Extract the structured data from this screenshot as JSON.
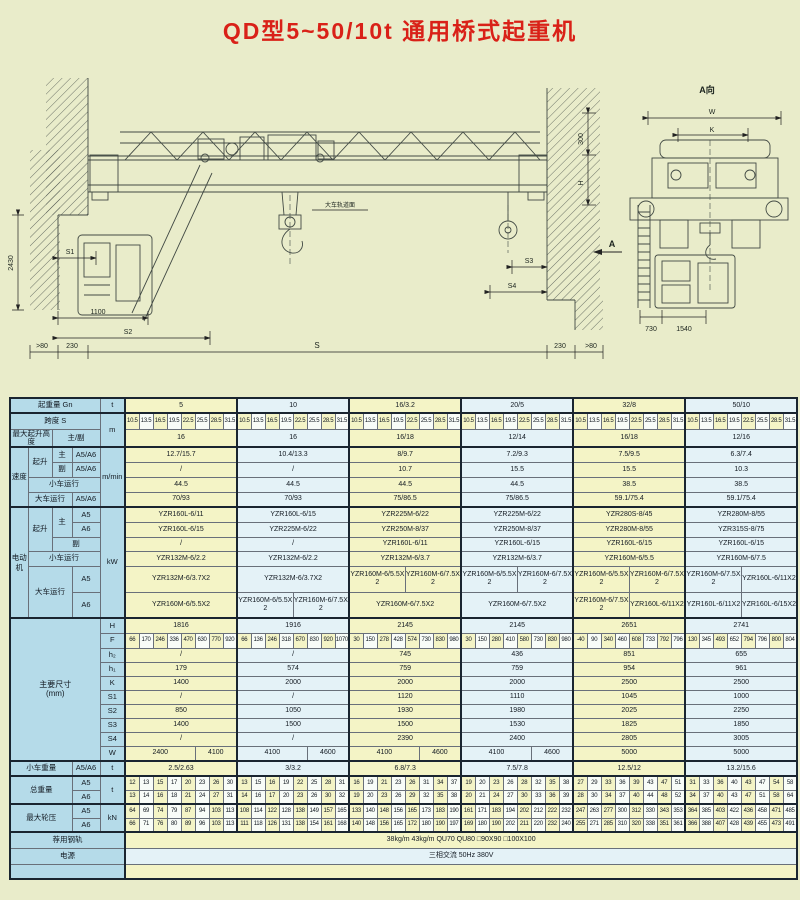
{
  "title": "QD型5~50/10t 通用桥式起重机",
  "drawing": {
    "view_label": "A向",
    "dim_W": "W",
    "dim_K": "K",
    "dim_S": "S",
    "dim_S1": "S1",
    "dim_S2": "S2",
    "dim_S3": "S3",
    "dim_S4": "S4",
    "dim_1100": "1100",
    "dim_2430": "2430",
    "dim_300": "300",
    "dim_H": "H",
    "dim_230_left": "230",
    "dim_230_right": "230",
    "gt80_left": ">80",
    "gt80_right": ">80",
    "rail_surface_note": "大车轨道面",
    "section_arrow": "A",
    "dim_730": "730",
    "dim_1540": "1540"
  },
  "table": {
    "labels": {
      "capacity": "起重量 Gn",
      "span": "跨度 S",
      "lift_height": "最大起升高度",
      "main_aux": "主/副",
      "speed": "速度",
      "hoist": "起升",
      "main": "主",
      "aux": "副",
      "trolley_travel": "小车运行",
      "crane_travel": "大车运行",
      "a5a6": "A5/A6",
      "a5": "A5",
      "a6": "A6",
      "motor": "电动机",
      "dims": "主要尺寸",
      "dims_unit": "(mm)",
      "trolley_weight": "小车重量",
      "total_weight": "总重量",
      "wheel_load": "最大轮压",
      "rail": "荐用钢轨",
      "power": "电源"
    },
    "units": {
      "capacity": "t",
      "span": "m",
      "speed": "m/min",
      "motor": "kW",
      "trolley_weight": "t",
      "total_weight": "t",
      "wheel_load": "kN"
    },
    "capacity_values": [
      "5",
      "10",
      "16/3.2",
      "20/5",
      "32/8",
      "50/10"
    ],
    "span_values": [
      [
        "10.5",
        "13.5",
        "16.5",
        "19.5",
        "22.5",
        "25.5",
        "28.5",
        "31.5"
      ],
      [
        "10.5",
        "13.5",
        "16.5",
        "19.5",
        "22.5",
        "25.5",
        "28.5",
        "31.5"
      ],
      [
        "10.5",
        "13.5",
        "16.5",
        "19.5",
        "22.5",
        "25.5",
        "28.5",
        "31.5"
      ],
      [
        "10.5",
        "13.5",
        "16.5",
        "19.5",
        "22.5",
        "25.5",
        "28.5",
        "31.5"
      ],
      [
        "10.5",
        "13.5",
        "16.5",
        "19.5",
        "22.5",
        "25.5",
        "28.5",
        "31.5"
      ],
      [
        "10.5",
        "13.5",
        "16.5",
        "19.5",
        "22.5",
        "25.5",
        "28.5",
        "31.5"
      ]
    ],
    "lift_height_values": [
      "16",
      "16",
      "16/18",
      "12/14",
      "16/18",
      "12/16"
    ],
    "speed": {
      "hoist_main": [
        "12.7/15.7",
        "10.4/13.3",
        "8/9.7",
        "7.2/9.3",
        "7.5/9.5",
        "6.3/7.4"
      ],
      "hoist_aux": [
        "/",
        "/",
        "10.7",
        "15.5",
        "15.5",
        "10.3"
      ],
      "trolley_travel": [
        "44.5",
        "44.5",
        "44.5",
        "44.5",
        "38.5",
        "38.5"
      ],
      "crane_travel": [
        "70/93",
        "70/93",
        "75/86.5",
        "75/86.5",
        "59.1/75.4",
        "59.1/75.4"
      ]
    },
    "motors": {
      "hoist_main_a5": [
        "YZR160L-6/11",
        "YZR160L-6/15",
        "YZR225M-6/22",
        "YZR225M-6/22",
        "YZR280S-8/45",
        "YZR280M-8/55"
      ],
      "hoist_main_a6": [
        "YZR160L-6/15",
        "YZR225M-6/22",
        "YZR250M-8/37",
        "YZR250M-8/37",
        "YZR280M-8/55",
        "YZR315S-8/75"
      ],
      "hoist_aux": [
        "/",
        "/",
        "YZR160L-6/11",
        "YZR160L-6/15",
        "YZR160L-6/15",
        "YZR160L-6/15"
      ],
      "trolley_travel": [
        "YZR132M-6/2.2",
        "YZR132M-6/2.2",
        "YZR132M-6/3.7",
        "YZR132M-6/3.7",
        "YZR160M-6/5.5",
        "YZR160M-6/7.5"
      ],
      "crane_travel_a5": [
        [
          "YZR132M-6/3.7X2"
        ],
        [
          "YZR132M-6/3.7X2"
        ],
        [
          "YZR160M-6/5.5X2",
          "YZR160M-6/7.5X2"
        ],
        [
          "YZR160M-6/5.5X2",
          "YZR160M-6/7.5X2"
        ],
        [
          "YZR160M-6/5.5X2",
          "YZR160M-6/7.5X2"
        ],
        [
          "YZR160M-6/7.5X2",
          "YZR160L-6/11X2"
        ]
      ],
      "crane_travel_a6": [
        [
          "YZR160M-6/5.5X2"
        ],
        [
          "YZR160M-6/5.5X2",
          "YZR160M-6/7.5X2"
        ],
        [
          "YZR160M-6/7.5X2"
        ],
        [
          "YZR160M-6/7.5X2"
        ],
        [
          "YZR160M-6/7.5X2",
          "YZR160L-6/11X2"
        ],
        [
          "YZR160L-6/11X2",
          "YZR160L-6/15X2"
        ]
      ]
    },
    "dim_names": [
      "H",
      "F",
      "h₂",
      "h₁",
      "K",
      "S1",
      "S2",
      "S3",
      "S4",
      "W"
    ],
    "dims": {
      "H": [
        "1816",
        "1916",
        "2145",
        "2145",
        "2651",
        "2741"
      ],
      "F": [
        [
          "66",
          "170",
          "246",
          "336",
          "470",
          "630",
          "770",
          "920"
        ],
        [
          "66",
          "136",
          "246",
          "318",
          "670",
          "830",
          "920",
          "1070"
        ],
        [
          "30",
          "150",
          "278",
          "428",
          "574",
          "730",
          "830",
          "980"
        ],
        [
          "30",
          "150",
          "280",
          "410",
          "580",
          "730",
          "830",
          "980"
        ],
        [
          "-40",
          "90",
          "340",
          "460",
          "608",
          "733",
          "792",
          "796"
        ],
        [
          "130",
          "345",
          "493",
          "652",
          "794",
          "796",
          "800",
          "804"
        ]
      ],
      "h2": [
        "/",
        "/",
        "745",
        "436",
        "851",
        "655"
      ],
      "h1": [
        "179",
        "574",
        "759",
        "759",
        "954",
        "961"
      ],
      "K": [
        "1400",
        "2000",
        "2000",
        "2000",
        "2500",
        "2500"
      ],
      "S1": [
        "/",
        "/",
        "1120",
        "1110",
        "1045",
        "1000"
      ],
      "S2": [
        "850",
        "1050",
        "1930",
        "1980",
        "2025",
        "2250"
      ],
      "S3": [
        "1400",
        "1500",
        "1500",
        "1530",
        "1825",
        "1850"
      ],
      "S4": [
        "/",
        "/",
        "2390",
        "2400",
        "2805",
        "3005"
      ],
      "W": [
        [
          "2400",
          "4100"
        ],
        [
          "4100",
          "4600"
        ],
        [
          "4100",
          "4600"
        ],
        [
          "4100",
          "4600"
        ],
        [
          "5000"
        ],
        [
          "5000"
        ]
      ]
    },
    "trolley_weight_values": [
      "2.5/2.63",
      "3/3.2",
      "6.8/7.3",
      "7.5/7.8",
      "12.5/12",
      "13.2/15.6"
    ],
    "total_weight": {
      "a5": [
        [
          "12",
          "13",
          "15",
          "17",
          "20",
          "23",
          "26",
          "30"
        ],
        [
          "13",
          "15",
          "16",
          "19",
          "22",
          "25",
          "28",
          "31"
        ],
        [
          "16",
          "19",
          "21",
          "23",
          "26",
          "31",
          "34",
          "37"
        ],
        [
          "19",
          "20",
          "23",
          "26",
          "28",
          "32",
          "35",
          "38"
        ],
        [
          "27",
          "29",
          "33",
          "36",
          "39",
          "43",
          "47",
          "51"
        ],
        [
          "31",
          "33",
          "36",
          "40",
          "43",
          "47",
          "54",
          "58"
        ]
      ],
      "a6": [
        [
          "13",
          "14",
          "16",
          "18",
          "21",
          "24",
          "27",
          "31"
        ],
        [
          "14",
          "16",
          "17",
          "20",
          "23",
          "26",
          "30",
          "32"
        ],
        [
          "19",
          "20",
          "23",
          "26",
          "29",
          "32",
          "35",
          "38"
        ],
        [
          "20",
          "21",
          "24",
          "27",
          "30",
          "33",
          "36",
          "39"
        ],
        [
          "28",
          "30",
          "34",
          "37",
          "40",
          "44",
          "48",
          "52"
        ],
        [
          "34",
          "37",
          "40",
          "43",
          "47",
          "51",
          "58",
          "64"
        ]
      ]
    },
    "wheel_load": {
      "a5": [
        [
          "64",
          "69",
          "74",
          "79",
          "87",
          "94",
          "103",
          "113"
        ],
        [
          "108",
          "114",
          "122",
          "128",
          "138",
          "149",
          "157",
          "165"
        ],
        [
          "133",
          "140",
          "148",
          "156",
          "165",
          "173",
          "183",
          "190"
        ],
        [
          "161",
          "171",
          "183",
          "194",
          "202",
          "212",
          "222",
          "232"
        ],
        [
          "247",
          "263",
          "277",
          "300",
          "312",
          "330",
          "343",
          "353"
        ],
        [
          "364",
          "385",
          "403",
          "422",
          "436",
          "458",
          "471",
          "485"
        ]
      ],
      "a6": [
        [
          "66",
          "71",
          "76",
          "80",
          "89",
          "96",
          "103",
          "113"
        ],
        [
          "111",
          "118",
          "126",
          "131",
          "138",
          "154",
          "161",
          "168"
        ],
        [
          "140",
          "148",
          "156",
          "165",
          "172",
          "180",
          "190",
          "197"
        ],
        [
          "169",
          "180",
          "190",
          "202",
          "211",
          "220",
          "232",
          "240"
        ],
        [
          "255",
          "271",
          "285",
          "310",
          "320",
          "338",
          "351",
          "361"
        ],
        [
          "366",
          "388",
          "407",
          "428",
          "439",
          "455",
          "473",
          "491"
        ]
      ]
    },
    "rail_value": "38kg/m  43kg/m  QU70  QU80  □90X90  □100X100",
    "power_value": "三相交流  50Hz  380V"
  }
}
